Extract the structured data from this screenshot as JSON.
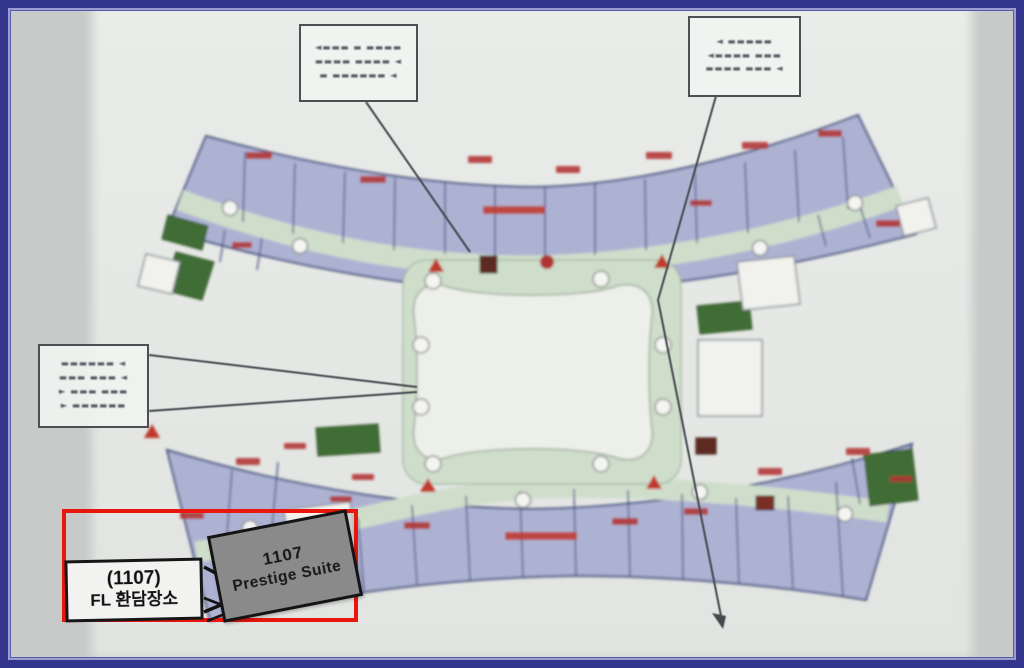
{
  "page": {
    "colors": {
      "border_navy": "#33368c",
      "page_bg": "#c7cac8",
      "photo_bg": "#e7e9e6",
      "highlight_red": "#e8160c",
      "suite_gray": "#8a8a8a",
      "room_lavender": "#adb2d3",
      "wall_blue": "#4a5481",
      "corridor_green": "#cfdecb",
      "garden_green": "#3f6d36",
      "courtyard_white": "#edefe9",
      "room_number_red": "#b23430"
    }
  },
  "callouts": {
    "top_left": {
      "lines": [
        "◄▬▬▬ ▬ ▬▬▬▬",
        "▬▬▬▬ ▬▬▬▬ ◄",
        "▬ ▬▬▬▬▬▬ ◄"
      ]
    },
    "top_right": {
      "lines": [
        "◄  ▬▬▬▬▬",
        "◄▬▬▬▬ ▬▬▬",
        "▬▬▬▬ ▬▬▬ ◄"
      ]
    },
    "left": {
      "lines": [
        "▬▬▬▬▬▬ ◄",
        "▬▬▬ ▬▬▬ ◄",
        "► ▬▬▬ ▬▬▬",
        "► ▬▬▬▬▬▬"
      ]
    }
  },
  "highlight": {
    "room_label_line1": "(1107)",
    "room_label_line2": "FL 환담장소",
    "suite_label_line1": "1107",
    "suite_label_line2": "Prestige Suite"
  }
}
